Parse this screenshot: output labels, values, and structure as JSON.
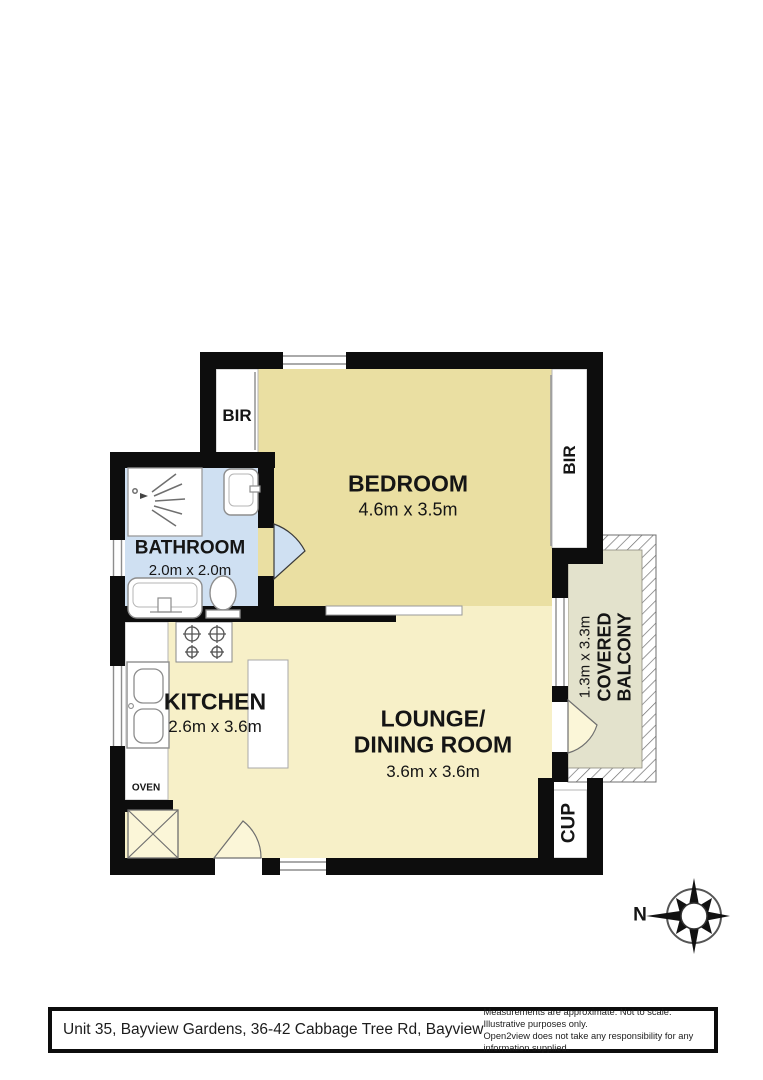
{
  "plan": {
    "rooms": {
      "bedroom": {
        "name": "BEDROOM",
        "dims": "4.6m x 3.5m"
      },
      "bathroom": {
        "name": "BATHROOM",
        "dims": "2.0m x 2.0m"
      },
      "kitchen": {
        "name": "KITCHEN",
        "dims": "2.6m x 3.6m"
      },
      "lounge": {
        "name_line1": "LOUNGE/",
        "name_line2": "DINING ROOM",
        "dims": "3.6m x 3.6m"
      },
      "balcony": {
        "dims": "1.3m x 3.3m",
        "name_line1": "COVERED",
        "name_line2": "BALCONY"
      }
    },
    "labels": {
      "bir_left": "BIR",
      "bir_right": "BIR",
      "cup": "CUP",
      "oven": "OVEN",
      "compass_north": "N"
    },
    "colors": {
      "bedroom_fill": "#eadfa2",
      "living_fill": "#f7f0c8",
      "bathroom_fill": "#cfe0f2",
      "balcony_fill": "#e3e2cc",
      "wall": "#0d0d0d"
    }
  },
  "footer": {
    "address": "Unit 35, Bayview Gardens, 36-42 Cabbage Tree Rd, Bayview",
    "disclaimer_line1": "Measurements are approximate. Not to scale. Illustrative purposes only.",
    "disclaimer_line2": "Open2view does not take any responsibility for any information supplied."
  }
}
